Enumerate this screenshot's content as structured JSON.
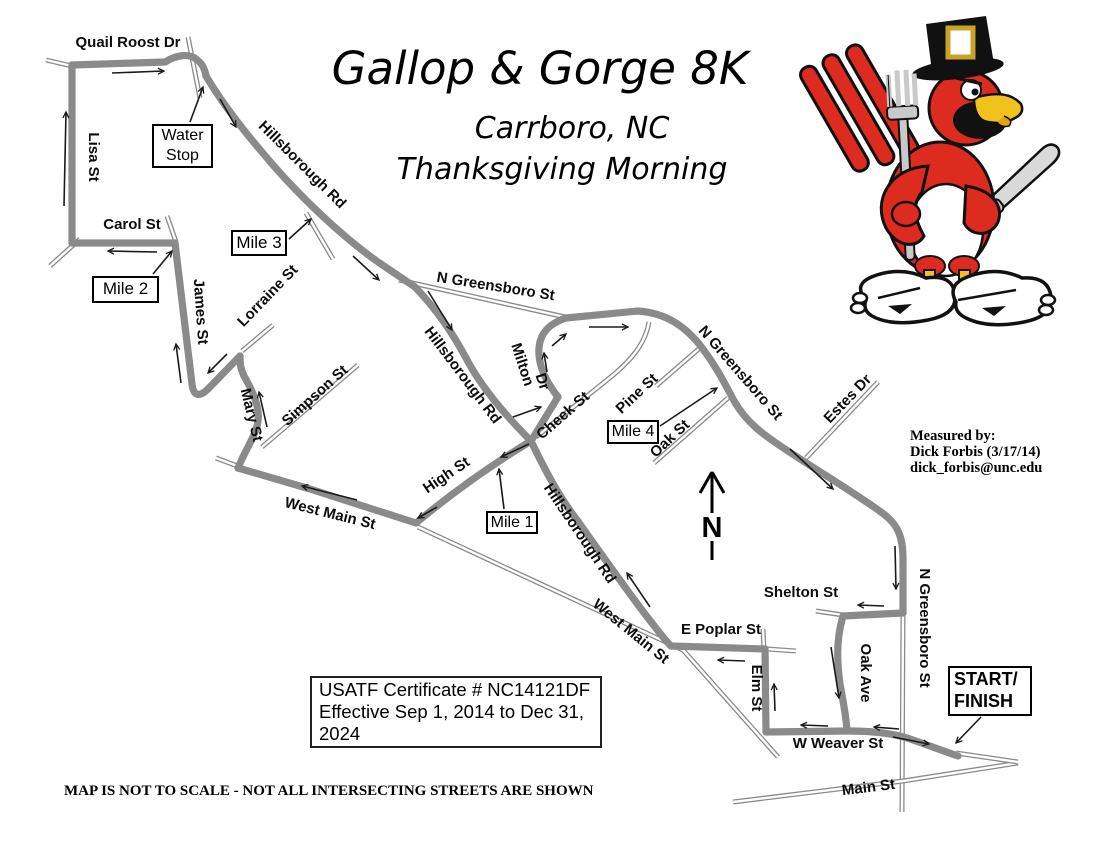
{
  "title": {
    "main": "Gallop & Gorge 8K",
    "city": "Carrboro, NC",
    "subtitle": "Thanksgiving Morning"
  },
  "credits": {
    "line1": "Measured by:",
    "line2": "Dick Forbis  (3/17/14)",
    "line3": "dick_forbis@unc.edu"
  },
  "certificate": {
    "line1": "USATF Certificate # NC14121DF",
    "line2": "Effective Sep 1, 2014 to Dec 31, 2024"
  },
  "disclaimer": "MAP IS NOT TO SCALE  - NOT ALL INTERSECTING STREETS ARE SHOWN",
  "north_indicator": "N",
  "mascot": "cardinal-turkey mascot with pilgrim hat, fork, knife and running shoes",
  "map": {
    "colors": {
      "road": "#8a8a8a",
      "ink": "#111111",
      "background": "#ffffff",
      "mascot_red": "#dd2b20",
      "mascot_yellow": "#f2c21c",
      "mascot_silver": "#cccccc"
    },
    "street_labels": [
      {
        "id": "quail-roost-dr",
        "text": "Quail Roost Dr",
        "x": 128,
        "y": 47,
        "rot": 0,
        "size": 15
      },
      {
        "id": "lisa-st",
        "text": "Lisa St",
        "x": 89,
        "y": 157,
        "rot": 90,
        "size": 15
      },
      {
        "id": "carol-st",
        "text": "Carol St",
        "x": 132,
        "y": 229,
        "rot": 0,
        "size": 15
      },
      {
        "id": "james-st",
        "text": "James St",
        "x": 196,
        "y": 312,
        "rot": 86,
        "size": 15
      },
      {
        "id": "lorraine-st",
        "text": "Lorraine St",
        "x": 271,
        "y": 299,
        "rot": -46,
        "size": 15
      },
      {
        "id": "mary-st",
        "text": "Mary St",
        "x": 247,
        "y": 416,
        "rot": 76,
        "size": 15
      },
      {
        "id": "simpson-st",
        "text": "Simpson St",
        "x": 318,
        "y": 399,
        "rot": -42,
        "size": 15
      },
      {
        "id": "hillsborough-rd-upper",
        "text": "Hillsborough Rd",
        "x": 299,
        "y": 168,
        "rot": 45,
        "size": 15
      },
      {
        "id": "n-greensboro-st-west",
        "text": "N Greensboro St",
        "x": 495,
        "y": 291,
        "rot": 9,
        "size": 15
      },
      {
        "id": "hillsborough-rd-mid",
        "text": "Hillsborough Rd",
        "x": 459,
        "y": 378,
        "rot": 53,
        "size": 15
      },
      {
        "id": "milton",
        "text": "Milton",
        "x": 518,
        "y": 366,
        "rot": 72,
        "size": 15
      },
      {
        "id": "milton-dr",
        "text": "Dr",
        "x": 538,
        "y": 383,
        "rot": 72,
        "size": 15
      },
      {
        "id": "cheek-st",
        "text": "Cheek St",
        "x": 566,
        "y": 419,
        "rot": -41,
        "size": 15
      },
      {
        "id": "pine-st",
        "text": "Pine St",
        "x": 640,
        "y": 397,
        "rot": -43,
        "size": 15
      },
      {
        "id": "oak-st",
        "text": "Oak St",
        "x": 673,
        "y": 442,
        "rot": -43,
        "size": 15
      },
      {
        "id": "n-greensboro-st-diag",
        "text": "N Greensboro St",
        "x": 737,
        "y": 376,
        "rot": 49,
        "size": 15
      },
      {
        "id": "estes-dr",
        "text": "Estes Dr",
        "x": 851,
        "y": 402,
        "rot": -46,
        "size": 15
      },
      {
        "id": "high-st",
        "text": "High St",
        "x": 449,
        "y": 479,
        "rot": -34,
        "size": 15
      },
      {
        "id": "west-main-st",
        "text": "West Main St",
        "x": 329,
        "y": 518,
        "rot": 14,
        "size": 15
      },
      {
        "id": "hillsborough-rd-lower",
        "text": "Hillsborough Rd",
        "x": 576,
        "y": 536,
        "rot": 56,
        "size": 15
      },
      {
        "id": "west-main-st-diag",
        "text": "West Main St",
        "x": 628,
        "y": 635,
        "rot": 39,
        "size": 15
      },
      {
        "id": "e-poplar-st",
        "text": "E Poplar St",
        "x": 721,
        "y": 634,
        "rot": 0,
        "size": 15
      },
      {
        "id": "elm-st",
        "text": "Elm St",
        "x": 752,
        "y": 688,
        "rot": 90,
        "size": 15
      },
      {
        "id": "oak-ave",
        "text": "Oak Ave",
        "x": 861,
        "y": 673,
        "rot": 90,
        "size": 15
      },
      {
        "id": "shelton-st",
        "text": "Shelton St",
        "x": 801,
        "y": 597,
        "rot": 0,
        "size": 15
      },
      {
        "id": "n-greensboro-st-vert",
        "text": "N Greensboro St",
        "x": 920,
        "y": 628,
        "rot": 90,
        "size": 15
      },
      {
        "id": "w-weaver-st",
        "text": "W Weaver St",
        "x": 838,
        "y": 748,
        "rot": 0,
        "size": 15
      },
      {
        "id": "main-st",
        "text": "Main St",
        "x": 869,
        "y": 792,
        "rot": -7,
        "size": 15
      }
    ],
    "markers": [
      {
        "id": "water-stop",
        "lines": [
          "Water",
          "Stop"
        ],
        "x": 152,
        "y": 124,
        "w": 61,
        "h": 44,
        "size": 16,
        "bold": false,
        "align": "center"
      },
      {
        "id": "mile-2",
        "lines": [
          "Mile 2"
        ],
        "x": 92,
        "y": 276,
        "w": 67,
        "h": 27,
        "size": 17,
        "bold": false,
        "align": "center"
      },
      {
        "id": "mile-3",
        "lines": [
          "Mile 3"
        ],
        "x": 231,
        "y": 230,
        "w": 56,
        "h": 26,
        "size": 17,
        "bold": false,
        "align": "center"
      },
      {
        "id": "mile-1",
        "lines": [
          "Mile 1"
        ],
        "x": 486,
        "y": 511,
        "w": 52,
        "h": 23,
        "size": 16,
        "bold": false,
        "align": "center"
      },
      {
        "id": "mile-4",
        "lines": [
          "Mile 4"
        ],
        "x": 607,
        "y": 420,
        "w": 52,
        "h": 24,
        "size": 16,
        "bold": false,
        "align": "center"
      },
      {
        "id": "start-finish",
        "lines": [
          "START/",
          "FINISH"
        ],
        "x": 948,
        "y": 666,
        "w": 84,
        "h": 50,
        "size": 18,
        "bold": true,
        "align": "left"
      }
    ]
  }
}
